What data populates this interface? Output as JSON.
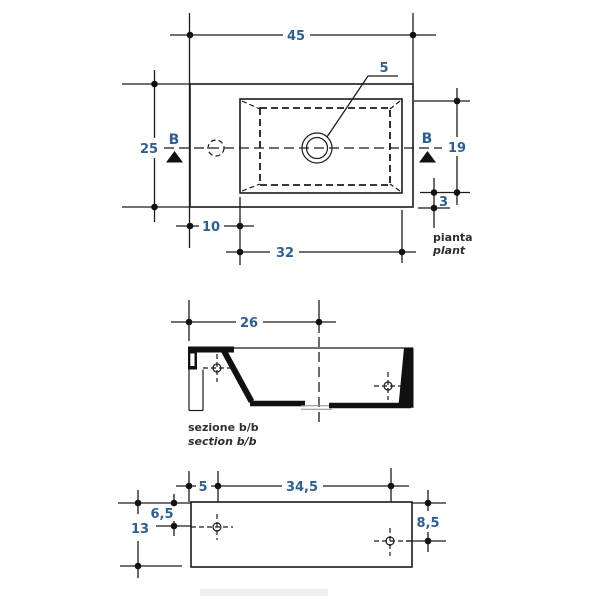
{
  "colors": {
    "line": "#1b1b1b",
    "dimension_text": "#2d5f92",
    "caption_text": "#2e2e2e"
  },
  "plan_view": {
    "caption_it": "pianta",
    "caption_en": "plant",
    "section_letter_left": "B",
    "section_letter_right": "B",
    "dim_overall_width": "45",
    "dim_overall_depth": "25",
    "dim_basin_depth": "19",
    "dim_back_rim": "3",
    "dim_tap_offset": "10",
    "dim_basin_width": "32",
    "dim_drain_hole": "5"
  },
  "section_view": {
    "caption_it": "sezione b/b",
    "caption_en": "section b/b",
    "dim_inner_width": "26"
  },
  "back_view": {
    "dim_hole_offset": "5",
    "dim_hole_spacing": "34,5",
    "dim_height_total": "13",
    "dim_hole_drop_left": "6,5",
    "dim_hole_drop_right": "8,5"
  }
}
